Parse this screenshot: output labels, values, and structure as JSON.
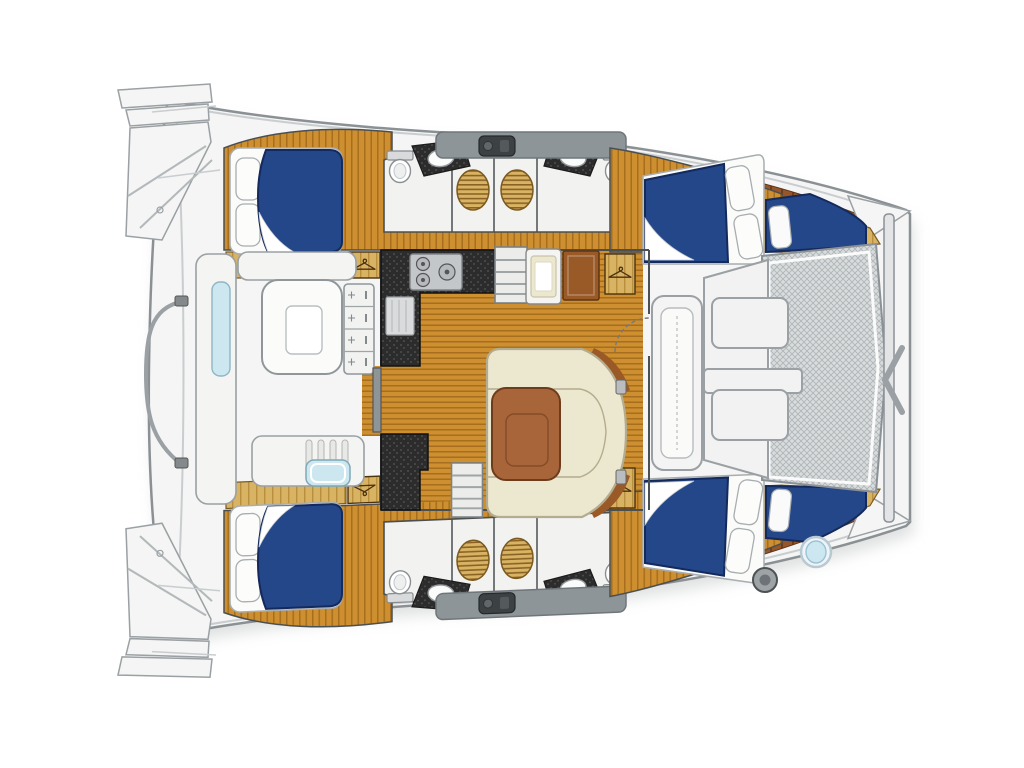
{
  "colors": {
    "hull_fill": "#f4f5f4",
    "hull_stroke": "#8a9094",
    "inner_line": "#c9cdcf",
    "deck_gray": "#8e9599",
    "deck_gray_dark": "#6f767a",
    "hatch_dark": "#3c4144",
    "wood": "#cd8f2f",
    "wood_stripe": "#a76f1d",
    "wood_tan": "#d9b364",
    "wood_tan_stripe": "#b98f3e",
    "deck_wood": "#96562a",
    "deck_wood_stripe": "#6e3c1a",
    "bed_blue": "#24478a",
    "bed_blue_dark": "#14295c",
    "mattress": "#fbfbfa",
    "pillow_stroke": "#a8adb0",
    "counter_dark": "#2c2c2c",
    "counter_speck": "#565656",
    "steel": "#c3c7c9",
    "sofa_cream": "#ece7cf",
    "sofa_stroke": "#b3ac8e",
    "table_wood": "#a9653a",
    "table_wood_dark": "#6e3c1c",
    "tramp_bg": "#d9dcdd",
    "tramp_line": "#aeb3b5",
    "cushion_blue": "#cde7f0",
    "white_room": "#f2f2f0",
    "wall": "#4a4f52",
    "grate_line": "#8a6224",
    "fitting": "#9aa0a3",
    "cab_wood": "#9a5a28",
    "cab_wood_dark": "#5f3514"
  },
  "features": {
    "boat": "catamaran-floor-plan",
    "aft_platform": "stern-swim-steps",
    "railing": "stern-railing",
    "cockpit": "aft-cockpit",
    "cockpit_table": "cockpit-table",
    "drawer_unit": "cockpit-drawer-unit",
    "cockpit_bench": "cockpit-bench",
    "cockpit_sink": "cockpit-sink",
    "salon": "salon",
    "galley": "galley-counter",
    "stove": "galley-stove",
    "fridge": "refrigerator",
    "cabinet": "galley-cabinet",
    "settee": "salon-settee",
    "table": "salon-table",
    "steps_port": "companionway-steps-port",
    "steps_stbd": "companionway-steps-starboard",
    "sliding_door": "cockpit-sliding-door",
    "door_arc": "forward-door-swing",
    "hull_port": "port-hull-unit",
    "hull_stbd": "starboard-hull-unit",
    "aft_cabin": "aft-cabin-double-berth",
    "fwd_cabin": "forward-cabin-double-berth",
    "crew_berth": "bow-crew-berth",
    "wardrobe": "hanging-locker",
    "head": "bathroom",
    "toilet": "toilet",
    "sink": "washbasin",
    "shower": "shower-grate",
    "roof_band": "side-deck-walkway",
    "hatch": "deck-hatch",
    "fwd_cockpit": "forward-cockpit",
    "fwd_seat": "forward-cockpit-seat",
    "tramp": "bow-trampoline",
    "beam": "forward-crossbeam",
    "bridle": "bow-bridle-fitting",
    "winch": "windlass",
    "crew_sink": "crew-washbasin"
  },
  "visible_feature_counts": {
    "double_berths": 4,
    "bathrooms": 4,
    "shower_grates": 4,
    "crew_berths": 2,
    "hanging_lockers": 6,
    "companionway_steps": 2,
    "salon_settee": 1,
    "cockpit_table": 1,
    "trampoline": 1
  }
}
